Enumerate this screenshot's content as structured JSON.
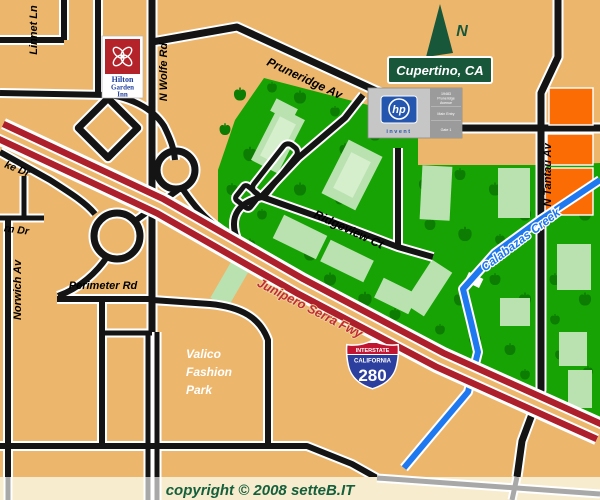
{
  "colors": {
    "background-tan": "#ECB76C",
    "strip-cream": "#F8ECCE",
    "campus-green": "#16A303",
    "tree-green": "#0C7C02",
    "building-green": "#B9E2B0",
    "building-green-light": "#D5EECB",
    "road-black": "#141414",
    "road-gray": "#A8A8A8",
    "freeway-red": "#AD1F2B",
    "creek-blue": "#1E78F0",
    "orange-building": "#FB6C05",
    "badge-green": "#19573B",
    "copyright-green": "#14603C",
    "fwy-label-red": "#C42B33",
    "hp-blue": "#2456B0",
    "hilton-red": "#B5232A",
    "hilton-text-blue": "#1E3F9F",
    "shield-red": "#C01430",
    "shield-blue": "#2D3F9E"
  },
  "labels": {
    "linnet_ln": "Linnet Ln",
    "n_wolfe_rd": "N Wolfe Rd",
    "pruneridge_av": "Pruneridge Av",
    "n_tantau_av": "N Tantau Av",
    "norwich_av": "Norwich Av",
    "perimeter_rd": "Perimeter Rd",
    "ke_dr": "ke Dr",
    "rn_dr": "rn Dr",
    "ridgeview_ct": "Ridgeview Ct",
    "junipero_serra_fwy": "Junipero Serra Fwy",
    "calabazas_creek": "Calabazas Creek"
  },
  "city_badge": {
    "text": "Cupertino, CA"
  },
  "north_arrow": {
    "label": "N",
    "icon": "north-arrow-triangle"
  },
  "valico_sign": {
    "lines": [
      "Valico",
      "Fashion",
      "Park"
    ]
  },
  "hp_sign": {
    "logo": "hp",
    "tagline": "invent",
    "address_lines": [
      "19483",
      "Pruneridge",
      "Avenue"
    ],
    "entry": "Main Entry",
    "gate": "Gate 1"
  },
  "hilton_sign": {
    "lines": [
      "Hilton",
      "Garden",
      "Inn"
    ],
    "icon": "hilton-flower"
  },
  "interstate_shield": {
    "top": "INTERSTATE",
    "state": "CALIFORNIA",
    "number": "280"
  },
  "footer": {
    "copyright": "copyright © 2008 setteB.IT"
  }
}
